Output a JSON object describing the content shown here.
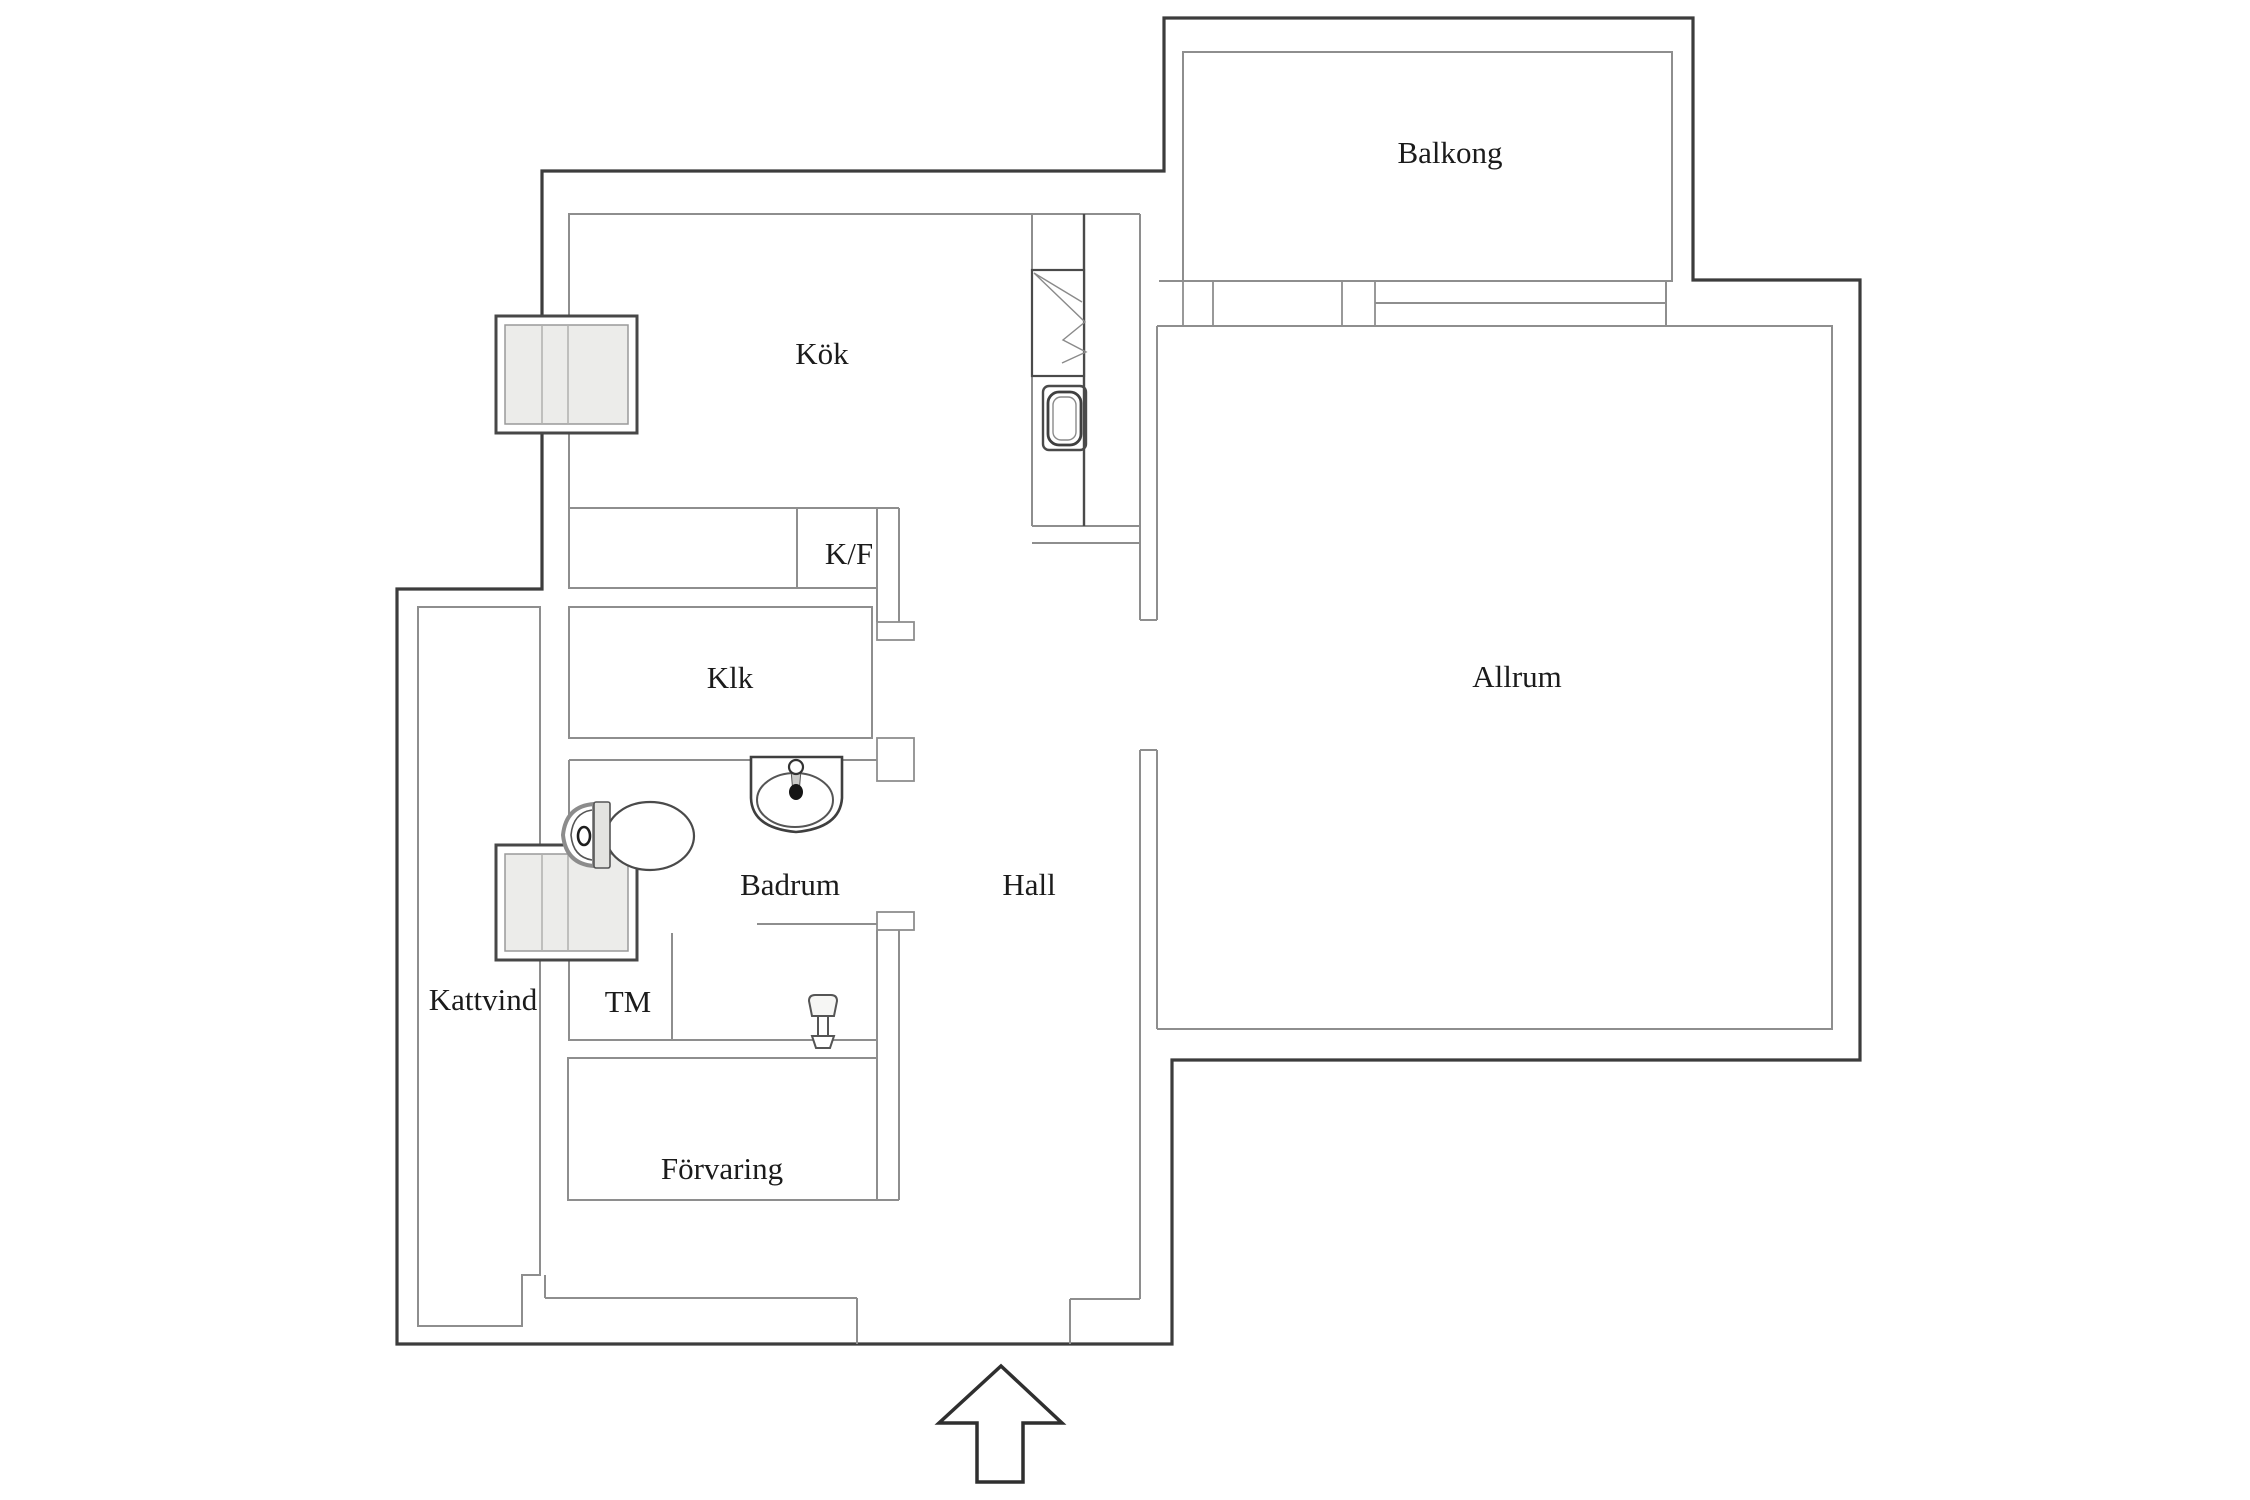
{
  "plan": {
    "type": "apartment-floor-plan",
    "rooms": {
      "balkong": {
        "label": "Balkong"
      },
      "kok": {
        "label": "Kök"
      },
      "kf": {
        "label": "K/F"
      },
      "klk": {
        "label": "Klk"
      },
      "badrum": {
        "label": "Badrum"
      },
      "hall": {
        "label": "Hall"
      },
      "allrum": {
        "label": "Allrum"
      },
      "kattvind": {
        "label": "Kattvind"
      },
      "tm": {
        "label": "TM"
      },
      "forvaring": {
        "label": "Förvaring"
      }
    },
    "colors": {
      "background": "#ffffff",
      "wall_outer": "#3c3c3c",
      "wall_inner": "#8e8e8e",
      "fixture_outline": "#4a4a4a",
      "window_glass": "#ececea",
      "text": "#1b1b1b"
    },
    "symbols": [
      "window-icon",
      "stove-icon",
      "kitchen-sink-icon",
      "toilet-icon",
      "washbasin-icon",
      "shower-icon",
      "entrance-arrow-icon"
    ]
  }
}
